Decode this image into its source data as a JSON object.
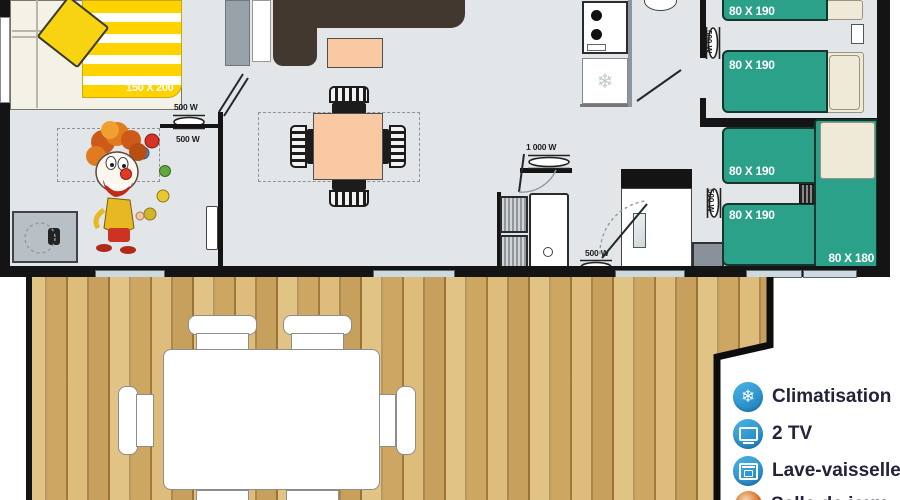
{
  "plan": {
    "master_bed_label": "150 X 200",
    "bed_labels": [
      "80 X 190",
      "80 X 190",
      "80 X 190",
      "80 X 190"
    ],
    "corner_bed_label": "80 X 180",
    "radiators": {
      "master_wall_top": "500 W",
      "master_wall_bottom": "500 W",
      "kitchen_wall": "500 W",
      "bedroom2_wall": "500 W",
      "bathroom_towel": "1 000 W",
      "bathroom_wall": "500 W"
    }
  },
  "legend": {
    "items": [
      {
        "icon": "snowflake-icon",
        "label": "Climatisation"
      },
      {
        "icon": "tv-icon",
        "label": "2 TV"
      },
      {
        "icon": "dishwasher-icon",
        "label": "Lave-vaisselle"
      },
      {
        "icon": "clown-icon",
        "label": "Salle de jeux"
      }
    ]
  },
  "colors": {
    "bed_green": "#2aa188",
    "duvet_yellow": "#ffd200",
    "peach": "#f9c9a4",
    "sofa_brown": "#43382f",
    "wood": "#d8b470",
    "wall": "#141414",
    "floor": "#e3e6e8",
    "legend_blue": "#2f9cd8",
    "legend_text": "#23233b"
  }
}
